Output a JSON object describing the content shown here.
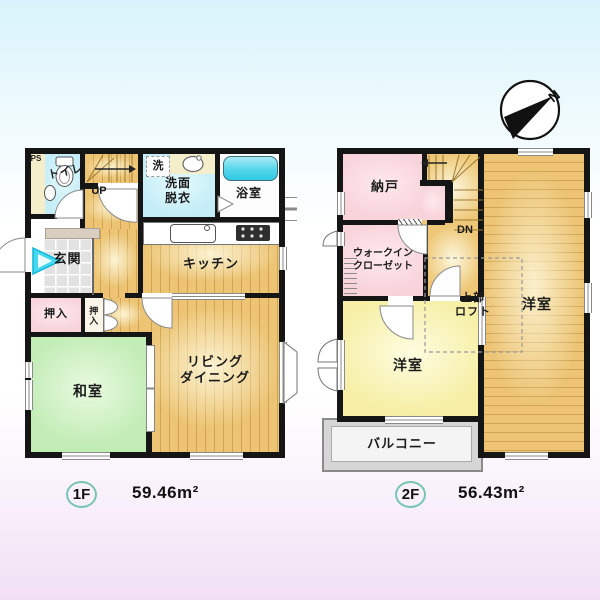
{
  "floor1": {
    "badge": "1F",
    "area": "59.46m²",
    "labels": {
      "ps": "PS",
      "toilet": "トイレ",
      "up": "UP",
      "washer": "洗",
      "washroom_l1": "洗面",
      "washroom_l2": "脱衣",
      "bath": "浴室",
      "kitchen": "キッチン",
      "genkan": "玄関",
      "closet_main": "押入",
      "closet_small": "押入",
      "washitsu": "和室",
      "living_l1": "リビング",
      "living_l2": "ダイニング"
    }
  },
  "floor2": {
    "badge": "2F",
    "area": "56.43m²",
    "labels": {
      "nando": "納戸",
      "dn": "DN",
      "wic_l1": "ウォークイン",
      "wic_l2": "クローゼット",
      "loft_l1": "上部",
      "loft_l2": "ロフト",
      "bedroom_left": "洋室",
      "bedroom_right": "洋室",
      "balcony": "バルコニー"
    }
  },
  "compass": {
    "north": "N"
  },
  "icons": {
    "compass": "compass-north-icon",
    "toilet": "toilet-icon",
    "bathtub": "bathtub-icon",
    "basin": "washbasin-icon",
    "sink": "kitchen-sink-icon",
    "stove": "stove-icon",
    "entry_arrow": "entrance-arrow-icon"
  },
  "colors": {
    "wall": "#151515",
    "wood": "#ecc474",
    "tatami": "#c3edb7",
    "water": "#c4edf7",
    "pink": "#f8d3da",
    "yellow": "#f6efa5",
    "tub": "#2fc9e4",
    "balcony": "#d6d6d6",
    "badge_ring": "#76c5b2",
    "bg_top": "#d7f3fb",
    "bg_bottom": "#f1dff4",
    "entry_arrow": "#45d8f1"
  }
}
